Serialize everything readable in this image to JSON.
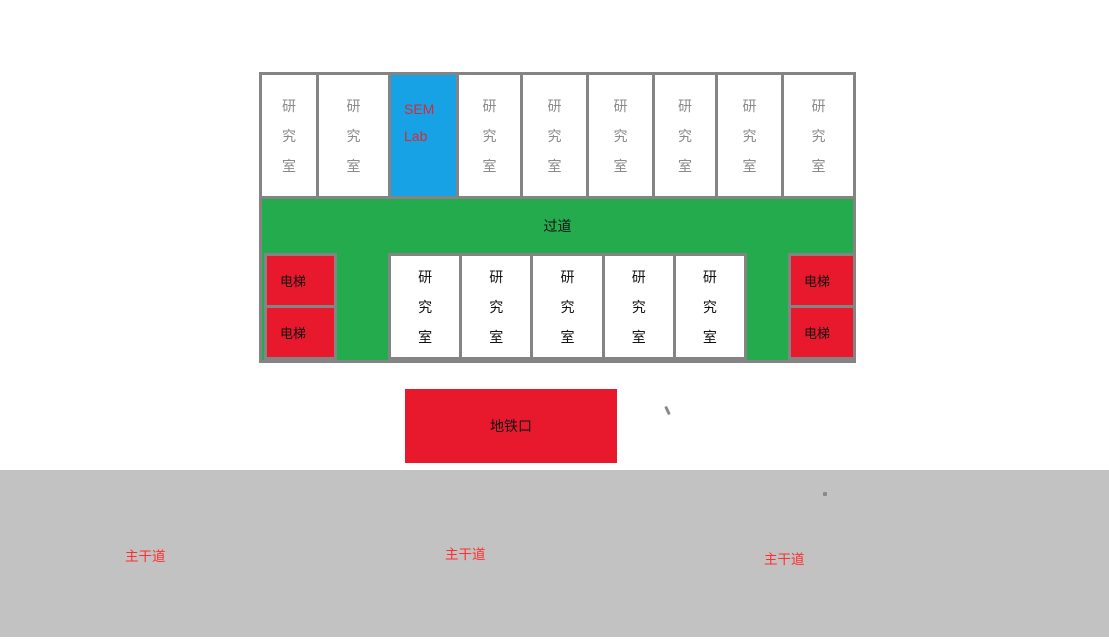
{
  "building": {
    "top_row": {
      "cells": [
        {
          "label": "研究室"
        },
        {
          "label": "研究室"
        },
        {
          "label_line1": "SEM",
          "label_line2": "Lab"
        },
        {
          "label": "研究室"
        },
        {
          "label": "研究室"
        },
        {
          "label": "研究室"
        },
        {
          "label": "研究室"
        },
        {
          "label": "研究室"
        },
        {
          "label": "研究室"
        }
      ]
    },
    "corridor_label": "过道",
    "bottom_row": {
      "left_elevators": [
        "电梯",
        "电梯"
      ],
      "rooms": [
        "研究室",
        "研究室",
        "研究室",
        "研究室",
        "研究室"
      ],
      "right_elevators": [
        "电梯",
        "电梯"
      ]
    }
  },
  "subway_label": "地铁口",
  "road_labels": [
    "主干道",
    "主干道",
    "主干道"
  ],
  "colors": {
    "border_gray": "#848484",
    "road_gray": "#c2c2c2",
    "corridor_green": "#23ab4d",
    "block_red": "#e8192d",
    "sem_lab_blue": "#18a2e6",
    "sem_lab_text": "#d42a35",
    "top_room_text": "#8a8a8a",
    "road_label_text": "#ff2d2d"
  }
}
